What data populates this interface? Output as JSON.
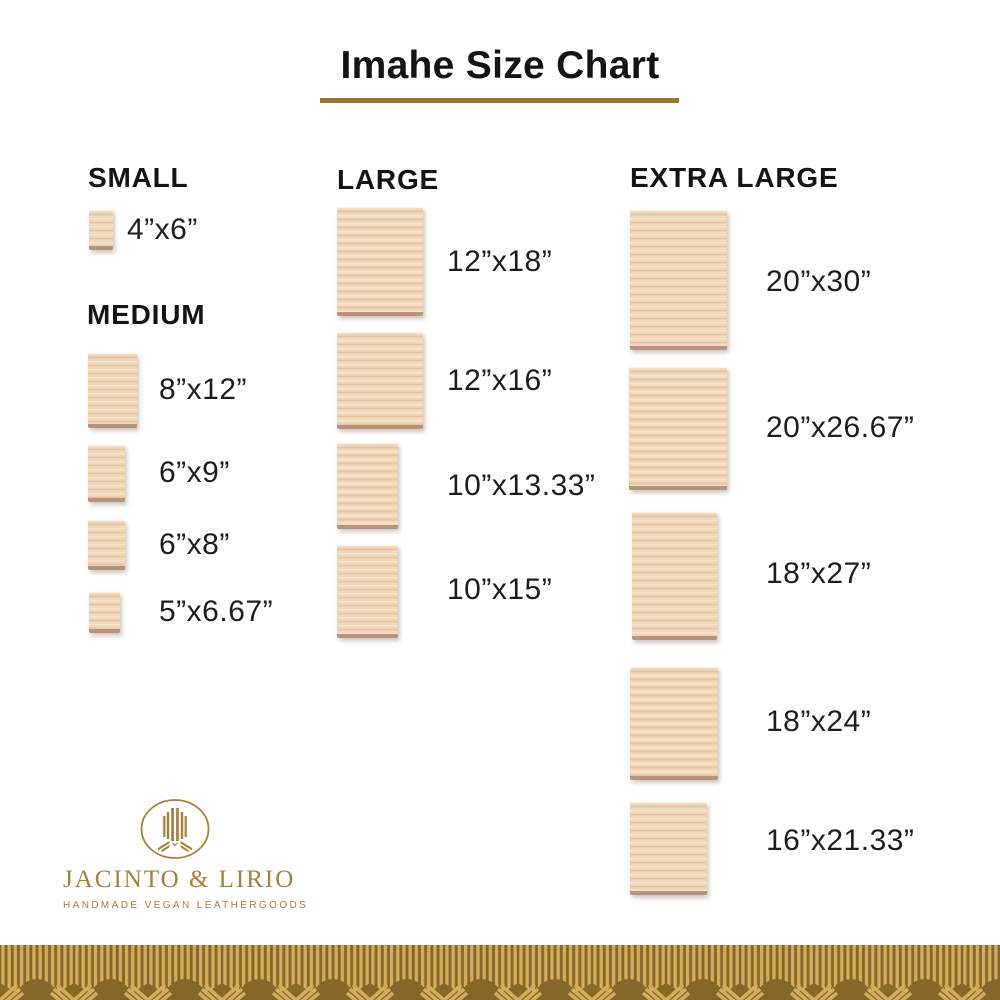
{
  "page": {
    "background": "#ffffff"
  },
  "title": {
    "text": "Imahe Size Chart",
    "underline_color": "#9a782e"
  },
  "colors": {
    "accent_gold": "#9a782e",
    "logo_gold": "#a5813c",
    "wood_base": "#f1d8bb",
    "wood_grain": "#c49c71",
    "wood_edge": "#b5937c",
    "border_dark_gold": "#87662a",
    "border_light_gold": "#d3ac5c",
    "text_dark": "#141414"
  },
  "chart_data": {
    "type": "table",
    "title": "Imahe Size Chart",
    "groups": [
      {
        "label": "SMALL",
        "items": [
          {
            "size": "4”x6”",
            "width_in": 4,
            "height_in": 6
          }
        ]
      },
      {
        "label": "MEDIUM",
        "items": [
          {
            "size": "8”x12”",
            "width_in": 8,
            "height_in": 12
          },
          {
            "size": "6”x9”",
            "width_in": 6,
            "height_in": 9
          },
          {
            "size": "6”x8”",
            "width_in": 6,
            "height_in": 8
          },
          {
            "size": "5”x6.67”",
            "width_in": 5,
            "height_in": 6.67
          }
        ]
      },
      {
        "label": "LARGE",
        "items": [
          {
            "size": "12”x18”",
            "width_in": 12,
            "height_in": 18
          },
          {
            "size": "12”x16”",
            "width_in": 12,
            "height_in": 16
          },
          {
            "size": "10”x13.33”",
            "width_in": 10,
            "height_in": 13.33
          },
          {
            "size": "10”x15”",
            "width_in": 10,
            "height_in": 15
          }
        ]
      },
      {
        "label": "EXTRA LARGE",
        "items": [
          {
            "size": "20”x30”",
            "width_in": 20,
            "height_in": 30
          },
          {
            "size": "20”x26.67”",
            "width_in": 20,
            "height_in": 26.67
          },
          {
            "size": "18”x27”",
            "width_in": 18,
            "height_in": 27
          },
          {
            "size": "18”x24”",
            "width_in": 18,
            "height_in": 24
          },
          {
            "size": "16”x21.33”",
            "width_in": 16,
            "height_in": 21.33
          }
        ]
      }
    ]
  },
  "logo": {
    "name": "JACINTO & LIRIO",
    "tagline": "HANDMADE VEGAN LEATHERGOODS"
  }
}
